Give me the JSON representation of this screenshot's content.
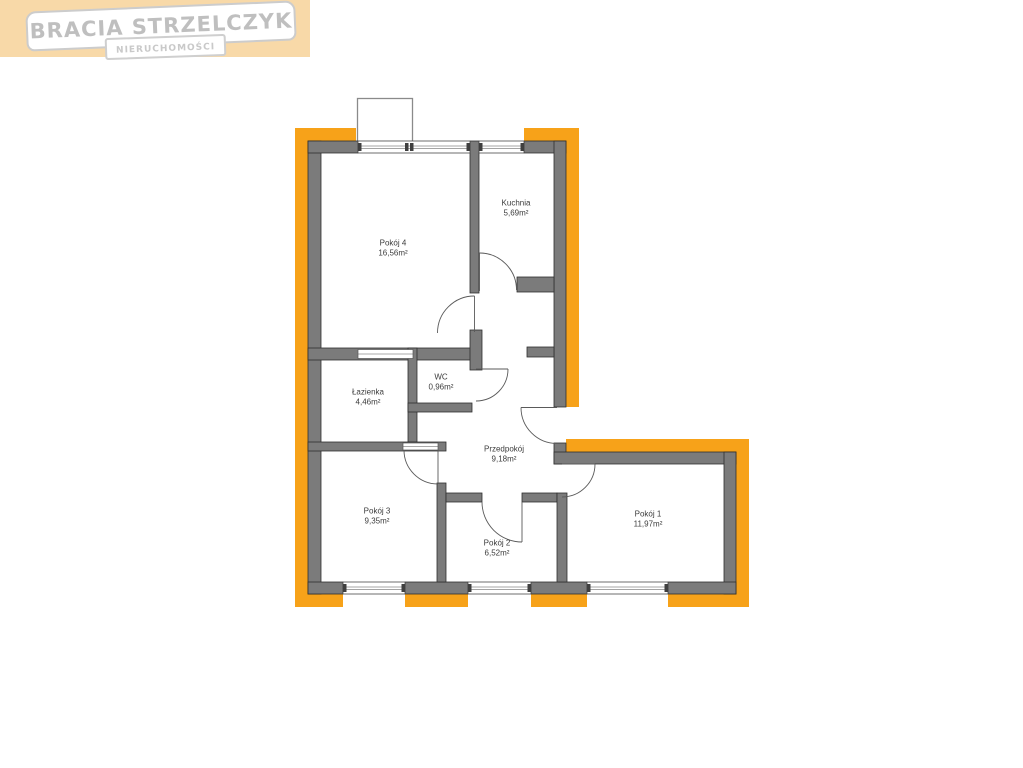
{
  "logo": {
    "title": "BRACIA STRZELCZYK",
    "subtitle": "NIERUCHOMOŚCI"
  },
  "floorplan": {
    "rooms": {
      "pokoj4": {
        "name": "Pokój 4",
        "area": "16,56m²"
      },
      "kuchnia": {
        "name": "Kuchnia",
        "area": "5,69m²"
      },
      "wc": {
        "name": "WC",
        "area": "0,96m²"
      },
      "lazienka": {
        "name": "Łazienka",
        "area": "4,46m²"
      },
      "przedpokoj": {
        "name": "Przedpokój",
        "area": "9,18m²"
      },
      "pokoj3": {
        "name": "Pokój 3",
        "area": "9,35m²"
      },
      "pokoj2": {
        "name": "Pokój 2",
        "area": "6,52m²"
      },
      "pokoj1": {
        "name": "Pokój 1",
        "area": "11,97m²"
      }
    },
    "colors": {
      "outline_orange": "#F7A219",
      "wall_gray": "#7B7B7B",
      "logo_background": "#F8D9A8",
      "logo_text": "#BFBFBF"
    }
  }
}
